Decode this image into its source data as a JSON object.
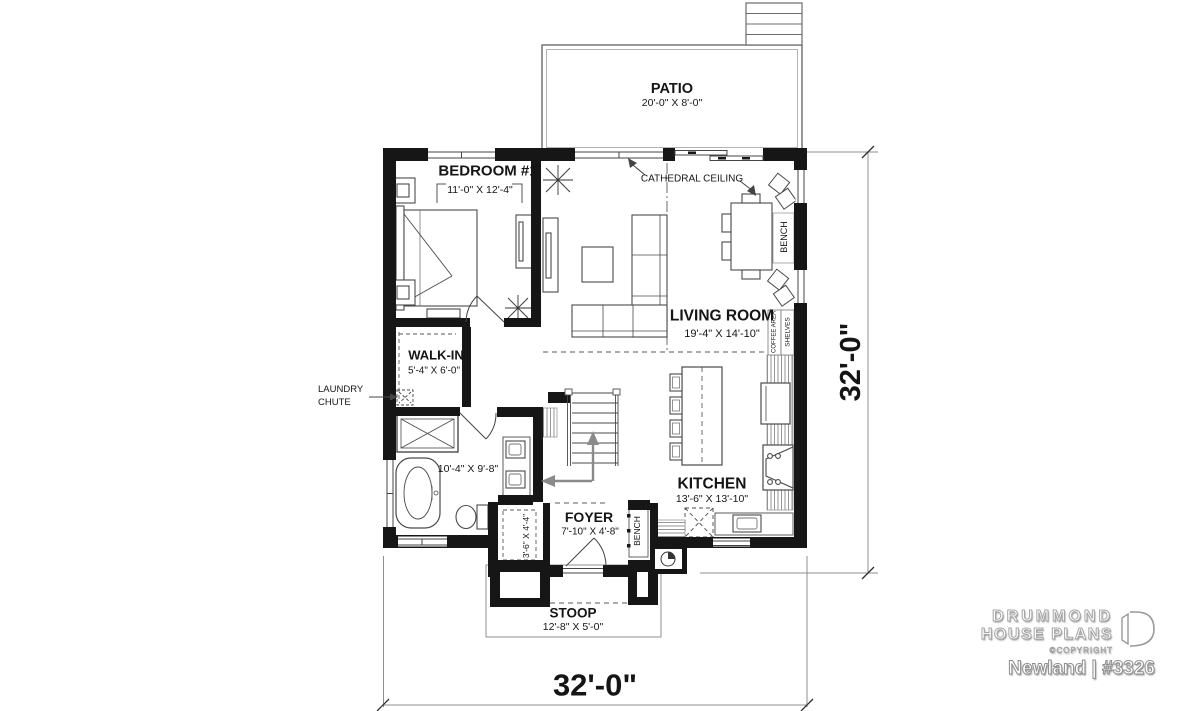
{
  "meta": {
    "plan_label": "Newland | #3326"
  },
  "brand": {
    "name_line1": "DRUMMOND",
    "name_line2": "HOUSE PLANS",
    "copyright": "©COPYRIGHT"
  },
  "dims": {
    "overall_width": "32'-0\"",
    "overall_depth": "32'-0\""
  },
  "rooms": {
    "patio": {
      "name": "PATIO",
      "size": "20'-0\" X 8'-0\""
    },
    "bedroom1": {
      "name": "BEDROOM #1",
      "size": "11'-0\" X 12'-4\""
    },
    "living": {
      "name": "LIVING ROOM",
      "size": "19'-4\" X 14'-10\""
    },
    "walkin": {
      "name": "WALK-IN",
      "size": "5'-4\" X 6'-0\""
    },
    "bath": {
      "size": "10'-4\" X 9'-8\""
    },
    "kitchen": {
      "name": "KITCHEN",
      "size": "13'-6\" X 13'-10\""
    },
    "foyer": {
      "name": "FOYER",
      "size": "7'-10\" X 4'-8\""
    },
    "closet": {
      "size": "3'-6\" X 4'-4\""
    },
    "stoop": {
      "name": "STOOP",
      "size": "12'-8\" X 5'-0\""
    }
  },
  "labels": {
    "cathedral": "CATHEDRAL CEILING",
    "laundry_line1": "LAUNDRY",
    "laundry_line2": "CHUTE",
    "bench_dining": "BENCH",
    "bench_foyer": "BENCH",
    "coffee_area": "COFFEE AREA",
    "shelves": "SHELVES"
  },
  "furniture": [
    "bed",
    "nightstands",
    "dresser",
    "plants",
    "tv-console",
    "sectional-sofa",
    "coffee-table",
    "dining-table",
    "dining-chairs",
    "bench-pillows",
    "kitchen-island",
    "stools",
    "refrigerator",
    "range-with-hood",
    "kitchen-sink",
    "pantry",
    "shower",
    "freestanding-tub",
    "toilet",
    "double-vanity",
    "stairs",
    "laundry-chute"
  ],
  "colors": {
    "wall": "#161616",
    "line": "#3f3f3f",
    "thin_line": "#8a8a8a",
    "text": "#151515"
  }
}
